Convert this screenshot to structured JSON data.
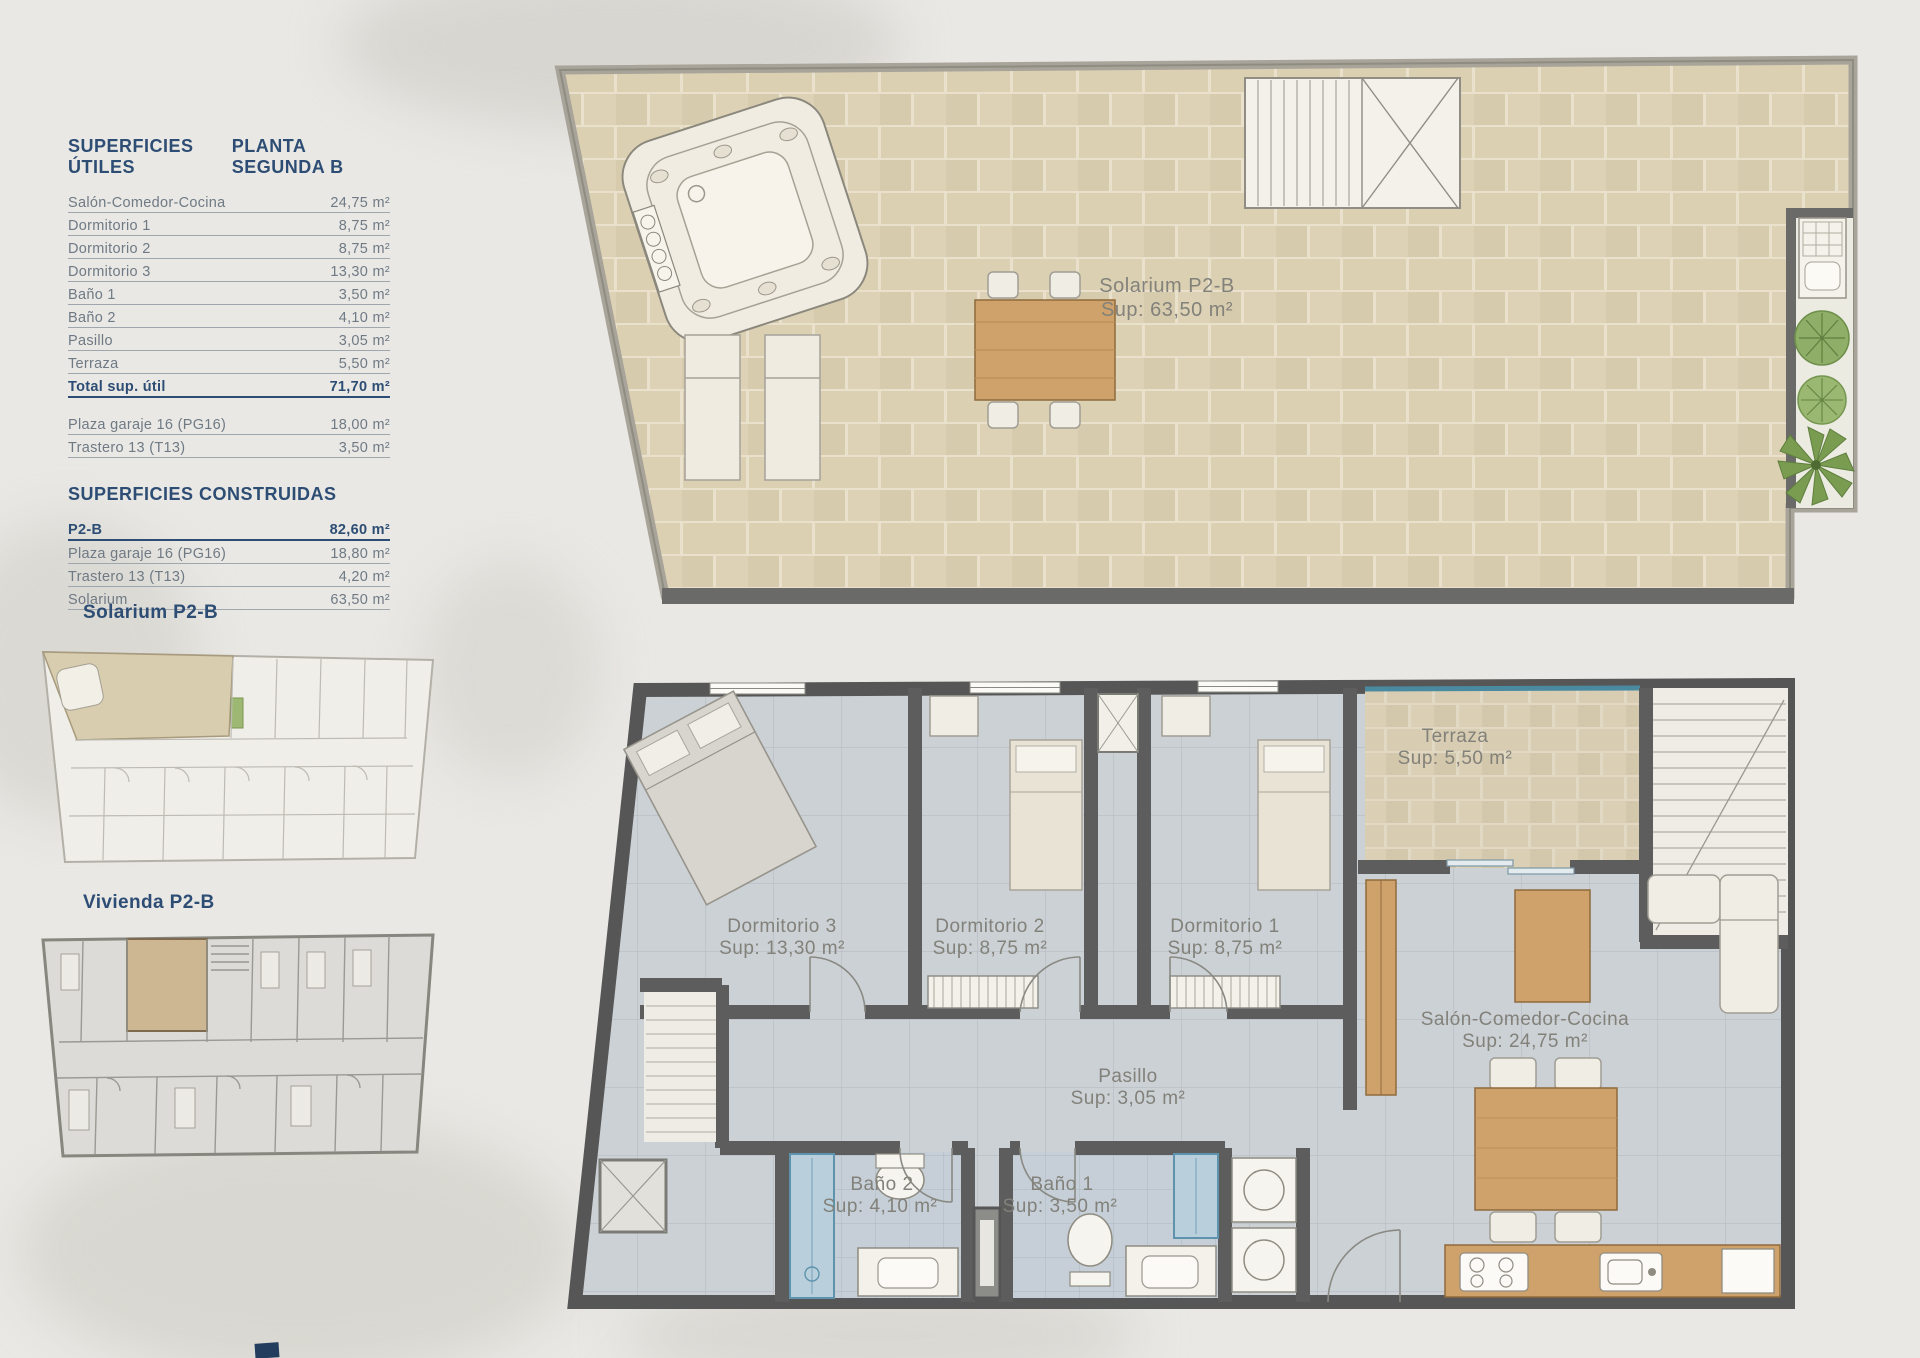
{
  "utiles": {
    "title": "SUPERFICIES ÚTILES",
    "plan_title": "PLANTA SEGUNDA B",
    "rows": [
      {
        "label": "Salón-Comedor-Cocina",
        "value": "24,75 m²"
      },
      {
        "label": "Dormitorio 1",
        "value": "8,75 m²"
      },
      {
        "label": "Dormitorio 2",
        "value": "8,75 m²"
      },
      {
        "label": "Dormitorio 3",
        "value": "13,30 m²"
      },
      {
        "label": "Baño 1",
        "value": "3,50 m²"
      },
      {
        "label": "Baño 2",
        "value": "4,10 m²"
      },
      {
        "label": "Pasillo",
        "value": "3,05 m²"
      },
      {
        "label": "Terraza",
        "value": "5,50 m²"
      }
    ],
    "total": {
      "label": "Total sup. útil",
      "value": "71,70 m²"
    },
    "anexos": [
      {
        "label": "Plaza garaje 16 (PG16)",
        "value": "18,00 m²"
      },
      {
        "label": "Trastero 13 (T13)",
        "value": "3,50 m²"
      }
    ]
  },
  "construidas": {
    "title": "SUPERFICIES CONSTRUIDAS",
    "rows": [
      {
        "label": "P2-B",
        "value": "82,60 m²"
      },
      {
        "label": "Plaza garaje 16 (PG16)",
        "value": "18,80 m²"
      },
      {
        "label": "Trastero 13 (T13)",
        "value": "4,20 m²"
      },
      {
        "label": "Solarium",
        "value": "63,50 m²"
      }
    ]
  },
  "headings": {
    "solarium_thumb": "Solarium P2-B",
    "vivienda_thumb": "Vivienda P2-B"
  },
  "solarium": {
    "name": "Solarium P2-B",
    "sup": "Sup: 63,50 m²"
  },
  "rooms": {
    "terraza": {
      "name": "Terraza",
      "sup": "Sup: 5,50 m²"
    },
    "dorm3": {
      "name": "Dormitorio 3",
      "sup": "Sup: 13,30 m²"
    },
    "dorm2": {
      "name": "Dormitorio 2",
      "sup": "Sup: 8,75 m²"
    },
    "dorm1": {
      "name": "Dormitorio 1",
      "sup": "Sup: 8,75 m²"
    },
    "salon": {
      "name": "Salón-Comedor-Cocina",
      "sup": "Sup: 24,75 m²"
    },
    "pasillo": {
      "name": "Pasillo",
      "sup": "Sup: 3,05 m²"
    },
    "bano2": {
      "name": "Baño 2",
      "sup": "Sup: 4,10 m²"
    },
    "bano1": {
      "name": "Baño 1",
      "sup": "Sup: 3,50 m²"
    }
  },
  "colors": {
    "accent": "#2d4d74",
    "table_text": "#6f7a85",
    "rule": "#9ea6ae",
    "label_gray": "#82817a",
    "wall": "#5d5d5d",
    "wood": "#cfa26b",
    "paper": "#e9e8e4",
    "tile_tan": "#dcd0b3",
    "floor_gray": "#ccd1d5",
    "bath_blue": "#c6cfd7",
    "glass_teal": "#4a8aa0",
    "plant_green": "#8faf68"
  }
}
